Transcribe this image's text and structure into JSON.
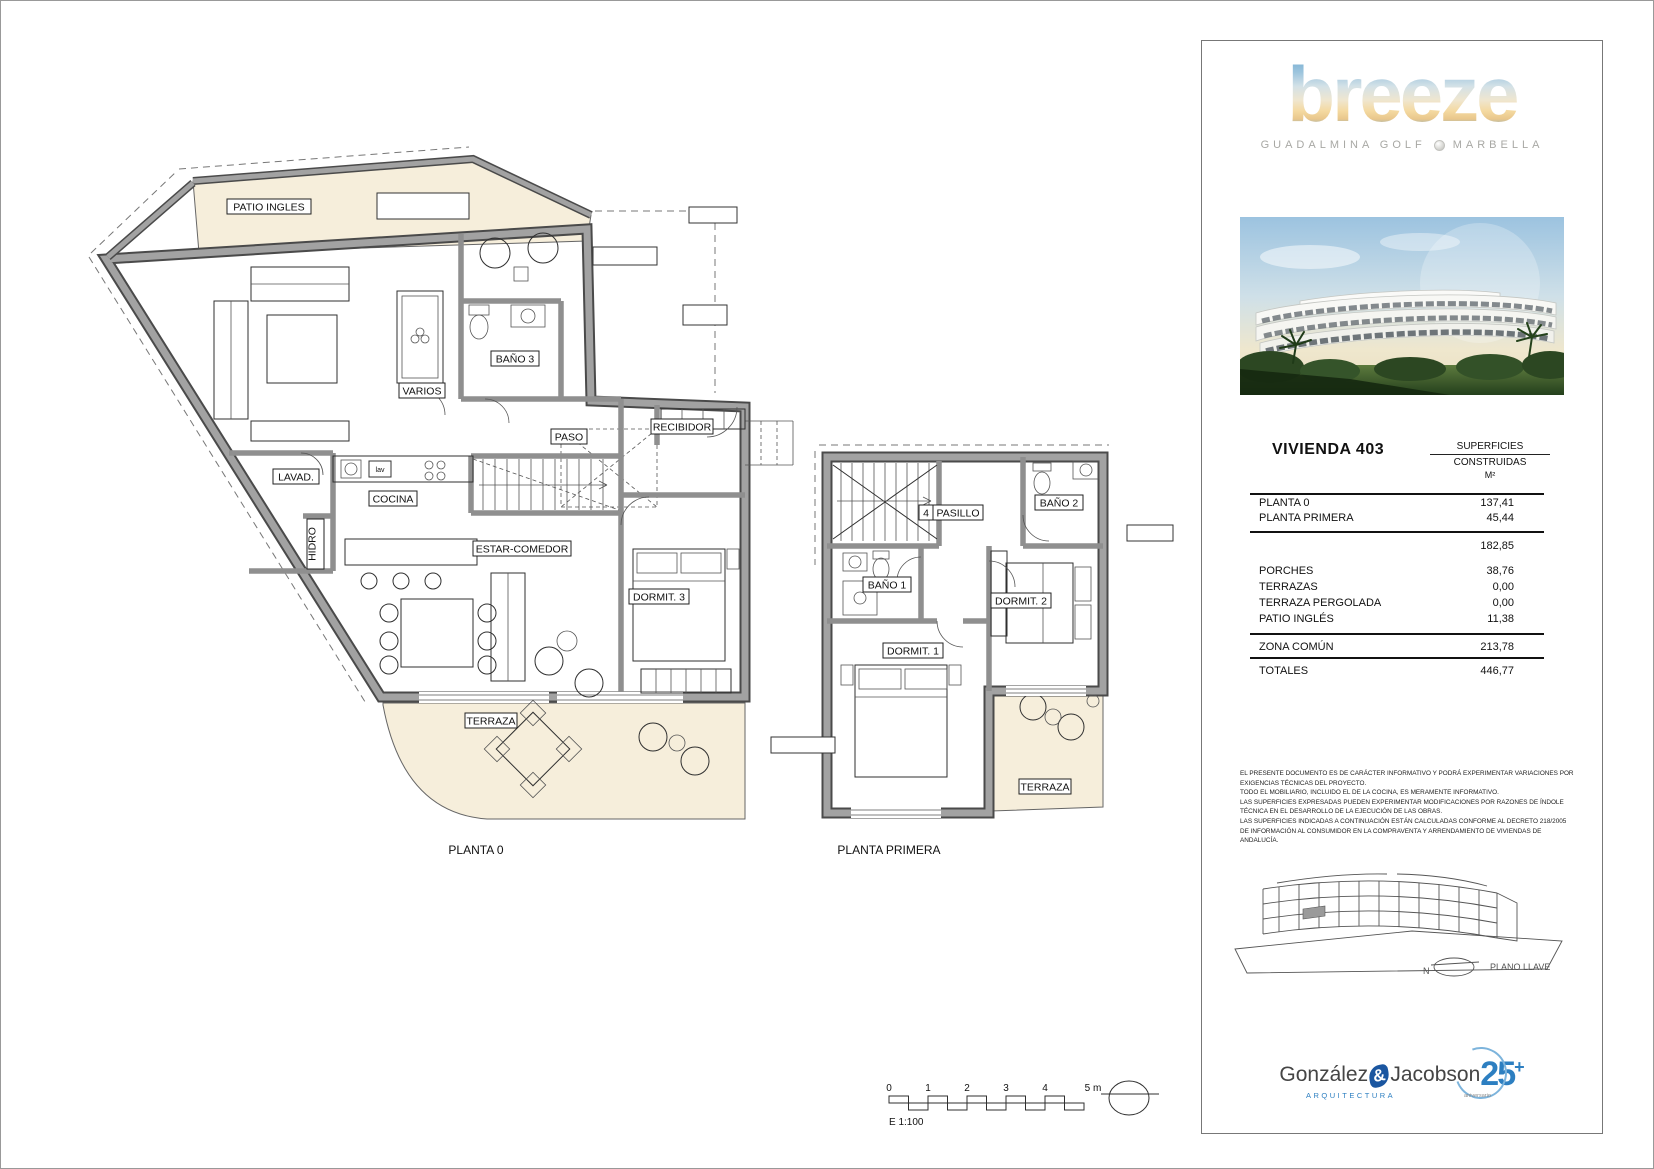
{
  "plans": {
    "planta0": {
      "caption": "PLANTA 0",
      "labels": {
        "patio": "PATIO  INGLES",
        "bano3": "BAÑO 3",
        "varios": "VARIOS",
        "paso": "PASO",
        "recibidor": "RECIBIDOR",
        "lavadero": "LAVAD.",
        "cocina": "COCINA",
        "hidro": "HIDRO",
        "estar": "ESTAR-COMEDOR",
        "dormit3": "DORMIT. 3",
        "terraza": "TERRAZA",
        "lav_tag": "lav"
      }
    },
    "planta1": {
      "caption": "PLANTA PRIMERA",
      "labels": {
        "pasillo": "PASILLO",
        "door_tag": "4",
        "bano2": "BAÑO 2",
        "bano1": "BAÑO 1",
        "dormit2": "DORMIT. 2",
        "dormit1": "DORMIT. 1",
        "terraza": "TERRAZA"
      }
    }
  },
  "scalebar": {
    "ticks": [
      "0",
      "1",
      "2",
      "3",
      "4"
    ],
    "end_label": "5 m",
    "scale_label": "E 1:100"
  },
  "sidebar": {
    "brand": {
      "logo": "breeze",
      "subtitle_left": "GUADALMINA GOLF",
      "subtitle_right": "MARBELLA"
    },
    "table": {
      "title": "VIVIENDA 403",
      "header": {
        "line1": "SUPERFICIES",
        "line2": "CONSTRUIDAS",
        "line3": "M²"
      },
      "rows_top": [
        {
          "label": "PLANTA 0",
          "value": "137,41"
        },
        {
          "label": "PLANTA PRIMERA",
          "value": "45,44"
        }
      ],
      "subtotal": "182,85",
      "rows_mid": [
        {
          "label": "PORCHES",
          "value": "38,76"
        },
        {
          "label": "TERRAZAS",
          "value": "0,00"
        },
        {
          "label": "TERRAZA PERGOLADA",
          "value": "0,00"
        },
        {
          "label": "PATIO INGLÉS",
          "value": "11,38"
        }
      ],
      "zona": {
        "label": "ZONA COMÚN",
        "value": "213,78"
      },
      "totales": {
        "label": "TOTALES",
        "value": "446,77"
      }
    },
    "legal_lines": [
      "EL PRESENTE DOCUMENTO ES DE CARÁCTER INFORMATIVO Y PODRÁ EXPERIMENTAR VARIACIONES POR EXIGENCIAS TÉCNICAS DEL PROYECTO.",
      "TODO EL MOBILIARIO, INCLUIDO EL DE LA COCINA, ES MERAMENTE INFORMATIVO.",
      "LAS SUPERFICIES EXPRESADAS PUEDEN EXPERIMENTAR MODIFICACIONES POR RAZONES DE ÍNDOLE TÉCNICA EN EL DESARROLLO DE LA EJECUCIÓN DE LAS OBRAS.",
      "LAS SUPERFICIES INDICADAS A CONTINUACIÓN ESTÁN CALCULADAS CONFORME AL DECRETO 218/2005 DE INFORMACIÓN AL CONSUMIDOR EN LA COMPRAVENTA Y ARRENDAMIENTO DE VIVIENDAS DE ANDALUCÍA."
    ],
    "keyplan": {
      "label": "PLANO LLAVE",
      "north": "N"
    },
    "architect": {
      "name1": "González",
      "amp": "&",
      "name2": "Jacobson",
      "years": "25",
      "plus": "+",
      "field": "ARQUITECTURA",
      "anniversary": "aniversario"
    }
  }
}
